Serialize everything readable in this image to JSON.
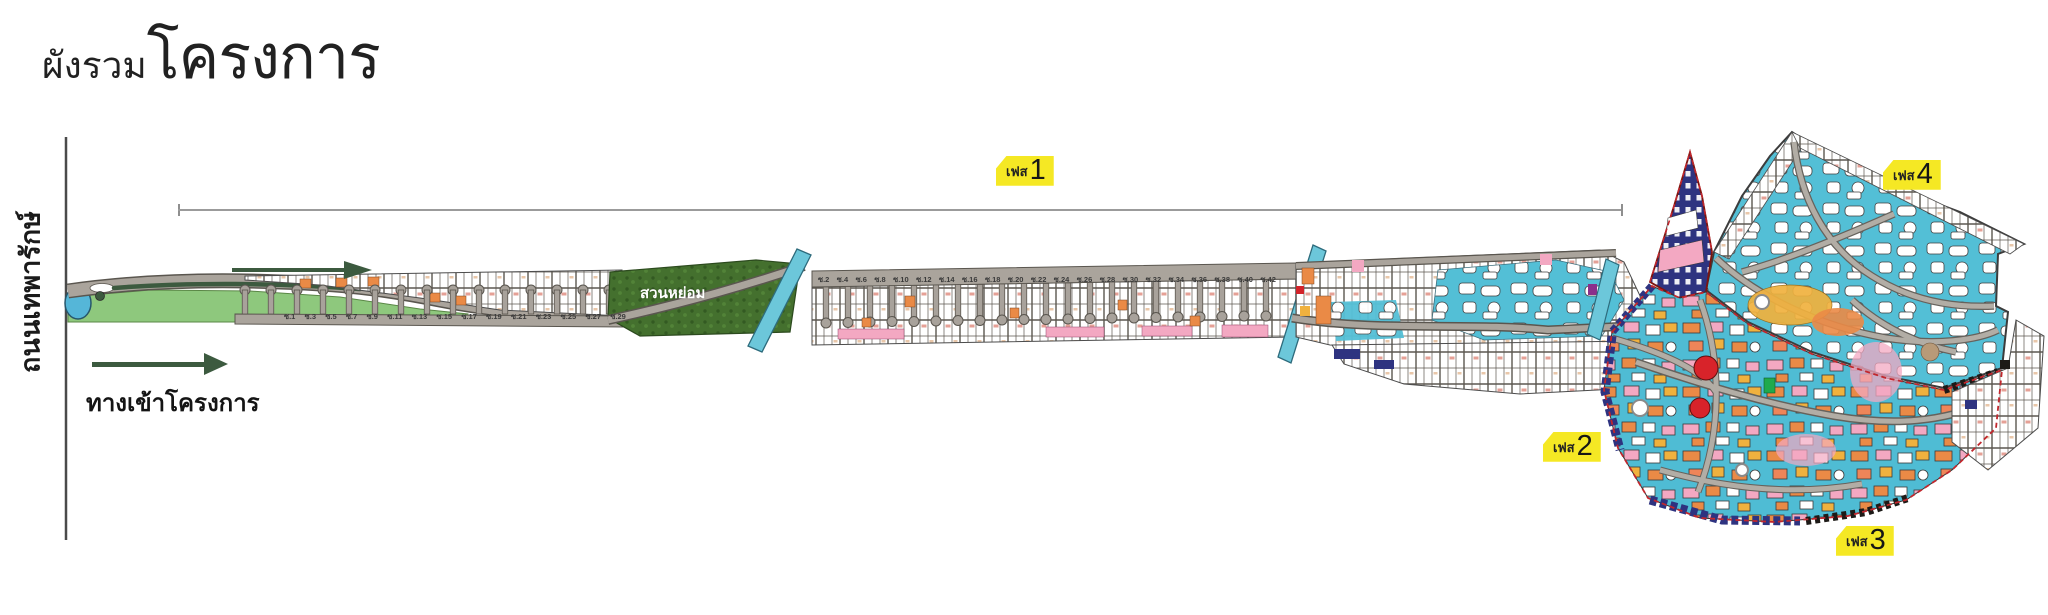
{
  "title": {
    "prefix": "ผังรวม",
    "main": "โครงการ"
  },
  "left_area": {
    "road_name": "ถนนเทพารักษ์",
    "entrance_label": "ทางเข้าโครงการ"
  },
  "garden": {
    "label": "สวนหย่อม"
  },
  "phases": [
    {
      "name": "phase-tag-1",
      "prefix": "เฟส",
      "number": "1",
      "x": 996,
      "y": 156
    },
    {
      "name": "phase-tag-2",
      "prefix": "เฟส",
      "number": "2",
      "x": 1543,
      "y": 432
    },
    {
      "name": "phase-tag-3",
      "prefix": "เฟส",
      "number": "3",
      "x": 1836,
      "y": 526
    },
    {
      "name": "phase-tag-4",
      "prefix": "เฟส",
      "number": "4",
      "x": 1883,
      "y": 160
    }
  ],
  "soi_lower": [
    "ซ.1",
    "ซ.3",
    "ซ.5",
    "ซ.7",
    "ซ.9",
    "ซ.11",
    "ซ.13",
    "ซ.15",
    "ซ.17",
    "ซ.19",
    "ซ.21",
    "ซ.23",
    "ซ.25",
    "ซ.27",
    "ซ.29"
  ],
  "soi_upper": [
    "ซ.2",
    "ซ.4",
    "ซ.6",
    "ซ.8",
    "ซ.10",
    "ซ.12",
    "ซ.14",
    "ซ.16",
    "ซ.18",
    "ซ.20",
    "ซ.22",
    "ซ.24",
    "ซ.26",
    "ซ.28",
    "ซ.30",
    "ซ.32",
    "ซ.34",
    "ซ.36",
    "ซ.38",
    "ซ.40",
    "ซ.42"
  ],
  "colors": {
    "phase_tag_bg": "#f5e824",
    "canal_water": "#6cc7da",
    "pond": "#55b6d8",
    "lawn_green": "#8ec87d",
    "garden_green": "#44702e",
    "road_gray": "#aaa49c",
    "plot_cyan": "#53bfd6",
    "plot_orange": "#ea8a46",
    "plot_pink": "#f3a8c2",
    "plot_navy": "#2e3380",
    "plot_yellow": "#f0b13e",
    "boundary_red": "#c1272d",
    "arrow_green": "#3c5a3f"
  }
}
